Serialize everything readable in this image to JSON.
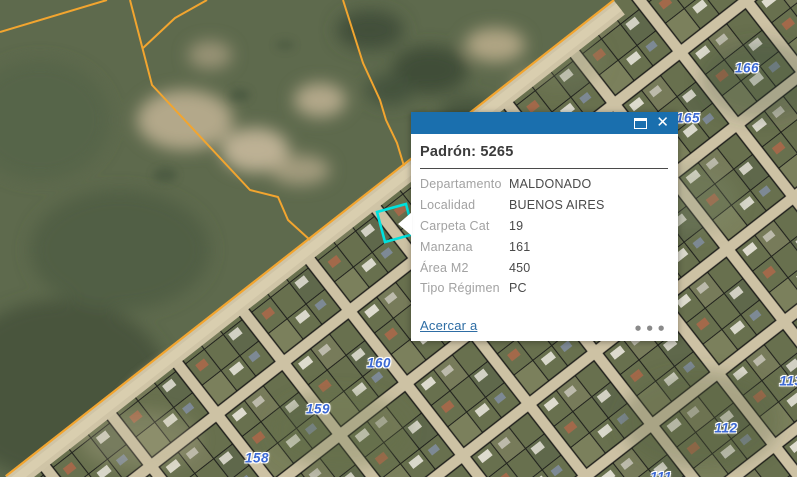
{
  "popup": {
    "title": "Padrón: 5265",
    "fields": [
      {
        "label": "Departamento",
        "value": "MALDONADO"
      },
      {
        "label": "Localidad",
        "value": "BUENOS AIRES"
      },
      {
        "label": "Carpeta Cat",
        "value": "19"
      },
      {
        "label": "Manzana",
        "value": "161"
      },
      {
        "label": "Área M2",
        "value": "450"
      },
      {
        "label": "Tipo Régimen",
        "value": "PC"
      }
    ],
    "zoom_link_label": "Acercar a",
    "icons": {
      "maximize": "window-maximize",
      "close_glyph": "✕",
      "more_options_glyph": "•••"
    },
    "header_color": "#1a6fae",
    "link_color": "#2e6da4"
  },
  "map": {
    "type": "aerial-cadastral-webmap",
    "selected_parcel_color": "#00e2df",
    "boundary_line_color": "#f2a52f",
    "block_label_color": "#3d6ad4",
    "block_labels": [
      {
        "text": "166",
        "x": 747,
        "y": 68
      },
      {
        "text": "165",
        "x": 688,
        "y": 118
      },
      {
        "text": "160",
        "x": 379,
        "y": 363
      },
      {
        "text": "159",
        "x": 318,
        "y": 409
      },
      {
        "text": "158",
        "x": 257,
        "y": 458
      },
      {
        "text": "112",
        "x": 726,
        "y": 428
      },
      {
        "text": "113",
        "x": 791,
        "y": 381
      },
      {
        "text": "111",
        "x": 661,
        "y": 477
      }
    ]
  }
}
